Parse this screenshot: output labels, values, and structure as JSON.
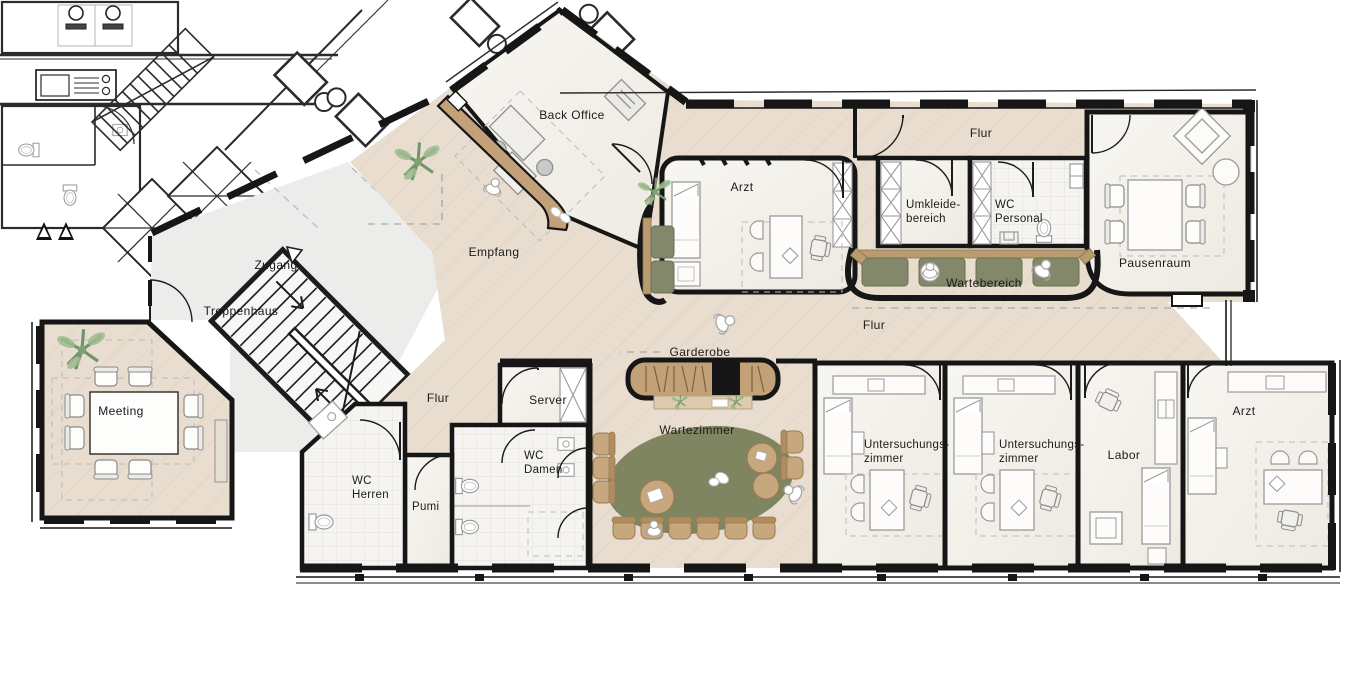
{
  "plan": {
    "labels": {
      "back_office": "Back Office",
      "flur_top": "Flur",
      "arzt_left": "Arzt",
      "umkleide_1": "Umkleide-",
      "umkleide_2": "bereich",
      "wc_personal_1": "WC",
      "wc_personal_2": "Personal",
      "pausenraum": "Pausenraum",
      "empfang": "Empfang",
      "zugang": "Zugang",
      "treppenhaus": "Treppenhaus",
      "wartebereich": "Wartebereich",
      "flur_main": "Flur",
      "garderobe": "Garderobe",
      "meeting": "Meeting",
      "flur_lower": "Flur",
      "server": "Server",
      "wc_herren_1": "WC",
      "wc_herren_2": "Herren",
      "pumi": "Pumi",
      "wc_damen_1": "WC",
      "wc_damen_2": "Damen",
      "wartezimmer": "Wartezimmer",
      "unters_1a": "Untersuchungs-",
      "unters_1b": "zimmer",
      "unters_2a": "Untersuchungs-",
      "unters_2b": "zimmer",
      "labor": "Labor",
      "arzt_right": "Arzt"
    },
    "colors": {
      "wall": "#161616",
      "floor_wood": "#e8ddcf",
      "floor_grain": "#dccfbd",
      "room": "#f5f3ee",
      "circulation": "#ecedeb",
      "wood": "#c2a178",
      "cushion": "#84886a",
      "rug": "#7e8560",
      "chair_tan": "#c7a77d",
      "plant": "#7da273"
    }
  }
}
